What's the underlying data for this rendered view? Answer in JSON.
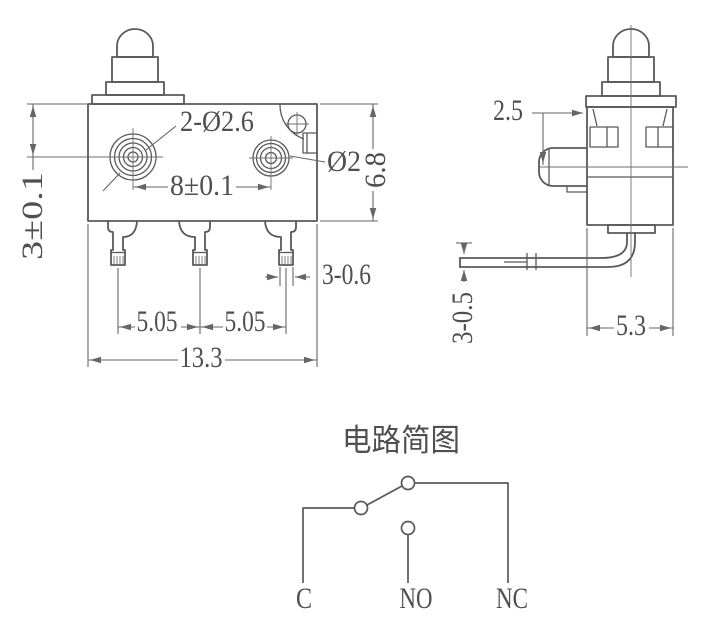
{
  "front": {
    "dims": {
      "hole_callout": "2-Ø2.6",
      "hole_spacing": "8±0.1",
      "top_to_center": "3±0.1",
      "pin_dia": "Ø2",
      "body_height": "6.8",
      "terminal_width": "3-0.6",
      "pitch_left": "5.05",
      "pitch_right": "5.05",
      "body_width": "13.3"
    }
  },
  "side": {
    "dims": {
      "top_offset": "2.5",
      "terminal_thickness": "3-0.5",
      "body_depth": "5.3"
    }
  },
  "circuit": {
    "title": "电路简图",
    "labels": {
      "common": "C",
      "normally_open": "NO",
      "normally_closed": "NC"
    }
  },
  "colors": {
    "outline": "#595959",
    "dimension": "#666666",
    "text": "#4f4f4f",
    "background": "#ffffff"
  }
}
